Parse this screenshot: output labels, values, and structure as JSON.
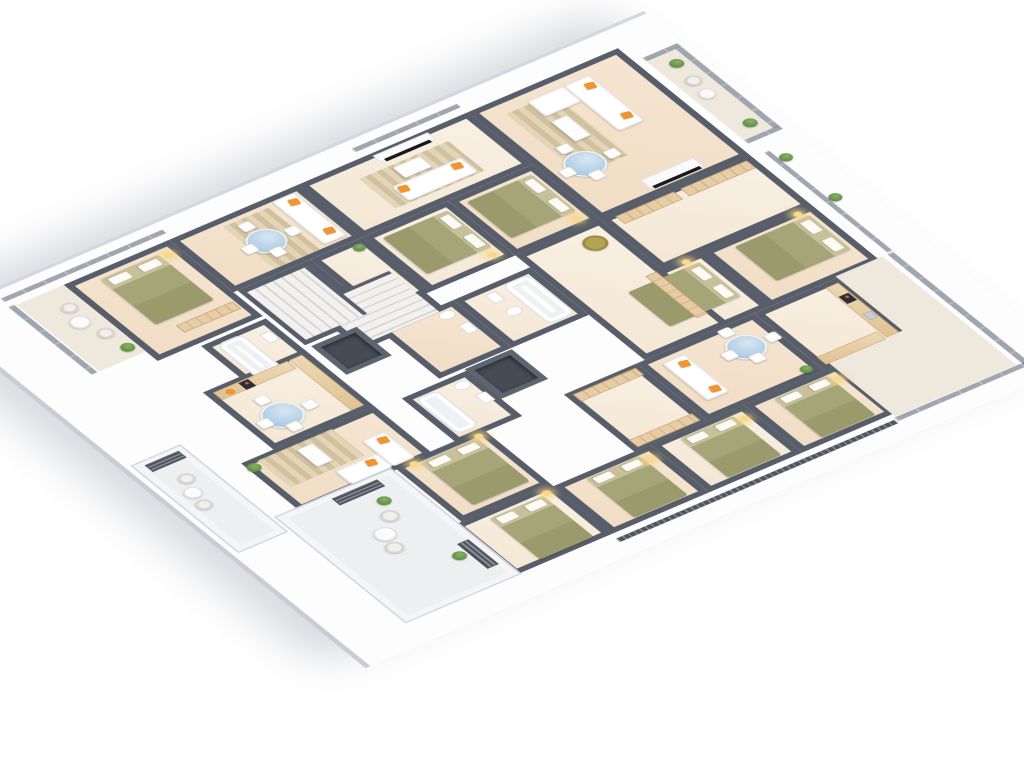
{
  "meta": {
    "description": "Isometric 3D rendering of an apartment building floor plan with dark grey walls, beige floors, furnished living rooms, bedrooms, kitchens, bathrooms, two staircases, elevator shafts and balconies with glass railings",
    "background": "#ffffff"
  },
  "palette": {
    "wall": "#575e69",
    "floor_warm": "#f4e3cf",
    "floor_light": "#f8efe2",
    "balcony_tile": "#efe8dc",
    "terrace_tile": "#edeff1",
    "slab": "#fdfdfe",
    "bed_olive": "#a2a173",
    "sofa_white": "#ffffff",
    "accent_orange": "#f0952f",
    "glass_table_blue": "#b9d4e7",
    "plant_green": "#6c9b50",
    "wood": "#e6cba2",
    "rail_glass": "#545e6e",
    "shaft_dark": "#454c56",
    "lamp_glow": "#f7d98b"
  },
  "scene": {
    "left": 620,
    "top": 40,
    "rotateX": 54,
    "rotateZ": 54,
    "width": 680,
    "height": 760
  },
  "slab": {
    "x": -26,
    "y": -48,
    "w": 736,
    "h": 876
  },
  "rooms": [
    {
      "name": "top-living",
      "k": "fa",
      "x": 10,
      "y": 10,
      "w": 225,
      "h": 185
    },
    {
      "name": "top-hall",
      "k": "fb",
      "x": 235,
      "y": 10,
      "w": 105,
      "h": 185
    },
    {
      "name": "top-bedroom-a",
      "k": "fa",
      "x": 340,
      "y": 10,
      "w": 115,
      "h": 135
    },
    {
      "name": "top-bedroom-b",
      "k": "fb",
      "x": 340,
      "y": 145,
      "w": 115,
      "h": 110
    },
    {
      "name": "right-kitchen",
      "k": "fb",
      "x": 455,
      "y": 60,
      "w": 120,
      "h": 105
    },
    {
      "name": "right-living",
      "k": "fa",
      "x": 455,
      "y": 165,
      "w": 120,
      "h": 145
    },
    {
      "name": "right-hall",
      "k": "fb",
      "x": 455,
      "y": 310,
      "w": 120,
      "h": 90
    },
    {
      "name": "right-bedroom-1",
      "k": "fa",
      "x": 575,
      "y": 150,
      "w": 100,
      "h": 115
    },
    {
      "name": "right-bedroom-2",
      "k": "fb",
      "x": 575,
      "y": 265,
      "w": 100,
      "h": 115
    },
    {
      "name": "right-bedroom-3",
      "k": "fa",
      "x": 575,
      "y": 380,
      "w": 100,
      "h": 120
    },
    {
      "name": "upper-bedroom-a",
      "k": "fa",
      "x": 120,
      "y": 195,
      "w": 115,
      "h": 105
    },
    {
      "name": "upper-bedroom-b",
      "k": "fb",
      "x": 120,
      "y": 300,
      "w": 115,
      "h": 105
    },
    {
      "name": "upper-living-tv",
      "k": "fb",
      "x": 10,
      "y": 195,
      "w": 110,
      "h": 210
    },
    {
      "name": "upper-living-2",
      "k": "fa",
      "x": 10,
      "y": 405,
      "w": 110,
      "h": 160
    },
    {
      "name": "hall-a",
      "k": "fb",
      "x": 235,
      "y": 195,
      "w": 220,
      "h": 105
    },
    {
      "name": "stairwell-a",
      "k": "fb",
      "x": 175,
      "y": 410,
      "w": 100,
      "h": 110
    },
    {
      "name": "bath-a",
      "k": "fb",
      "x": 260,
      "y": 300,
      "w": 100,
      "h": 95
    },
    {
      "name": "bath-b",
      "k": "fa",
      "x": 260,
      "y": 395,
      "w": 100,
      "h": 90
    },
    {
      "name": "bath-c",
      "k": "fb",
      "x": 365,
      "y": 455,
      "w": 95,
      "h": 80
    },
    {
      "name": "hall-b",
      "k": "fb",
      "x": 120,
      "y": 405,
      "w": 115,
      "h": 65
    },
    {
      "name": "stairwell-b",
      "k": "fb",
      "x": 120,
      "y": 470,
      "w": 115,
      "h": 90
    },
    {
      "name": "bath-left",
      "k": "fb",
      "x": 175,
      "y": 565,
      "w": 85,
      "h": 80
    },
    {
      "name": "left-bedroom",
      "k": "fa",
      "x": 10,
      "y": 565,
      "w": 160,
      "h": 130
    },
    {
      "name": "left-balcony",
      "k": "balc",
      "x": 10,
      "y": 695,
      "w": 140,
      "h": 58
    },
    {
      "name": "kitchen-bottom",
      "k": "fb",
      "x": 240,
      "y": 565,
      "w": 120,
      "h": 125
    },
    {
      "name": "living-bottom",
      "k": "fa",
      "x": 360,
      "y": 565,
      "w": 100,
      "h": 165
    },
    {
      "name": "bottom-bedroom-1",
      "k": "fa",
      "x": 455,
      "y": 500,
      "w": 115,
      "h": 110
    },
    {
      "name": "bottom-bedroom-corner",
      "k": "fb",
      "x": 570,
      "y": 500,
      "w": 105,
      "h": 120
    },
    {
      "name": "top-balcony",
      "k": "balc",
      "x": 44,
      "y": -36,
      "w": 168,
      "h": 36
    },
    {
      "name": "right-terrace-strip",
      "k": "balc",
      "x": 452,
      "y": 4,
      "w": 228,
      "h": 58
    },
    {
      "name": "right-terrace-corner",
      "k": "balc",
      "x": 566,
      "y": 4,
      "w": 114,
      "h": 150
    },
    {
      "name": "bottom-terrace",
      "k": "terr",
      "x": 455,
      "y": 615,
      "w": 220,
      "h": 140
    },
    {
      "name": "outer-terrace",
      "k": "terr",
      "x": 300,
      "y": 762,
      "w": 180,
      "h": 58
    }
  ],
  "railings": [
    {
      "kind": "glass",
      "x": 44,
      "y": -43,
      "w": 168,
      "h": 7
    },
    {
      "kind": "glassv",
      "x": 38,
      "y": -43,
      "w": 7,
      "h": 43
    },
    {
      "kind": "glassv",
      "x": 211,
      "y": -43,
      "w": 7,
      "h": 43
    },
    {
      "kind": "glass",
      "x": 240,
      "y": -10,
      "w": 210,
      "h": 6
    },
    {
      "kind": "glass",
      "x": 452,
      "y": -9,
      "w": 236,
      "h": 7
    },
    {
      "kind": "glassv",
      "x": 681,
      "y": -4,
      "w": 7,
      "h": 160
    },
    {
      "kind": "slat",
      "x": 684,
      "y": 158,
      "w": 7,
      "h": 344
    },
    {
      "kind": "glassv",
      "x": -8,
      "y": 196,
      "w": 7,
      "h": 130
    },
    {
      "kind": "glassv",
      "x": -8,
      "y": 560,
      "w": 7,
      "h": 200
    },
    {
      "kind": "glass",
      "x": 8,
      "y": 755,
      "w": 142,
      "h": 7
    }
  ],
  "furniture": [
    {
      "t": "rug",
      "x": 35,
      "y": 108,
      "w": 128,
      "h": 58
    },
    {
      "t": "sofa",
      "x": 30,
      "y": 60,
      "w": 95,
      "h": 32
    },
    {
      "t": "sofa",
      "x": 30,
      "y": 92,
      "w": 32,
      "h": 45
    },
    {
      "t": "pillow",
      "x": 40,
      "y": 64,
      "w": 11,
      "h": 11
    },
    {
      "t": "pillow",
      "x": 102,
      "y": 64,
      "w": 11,
      "h": 11
    },
    {
      "t": "coffee",
      "x": 72,
      "y": 118,
      "w": 42,
      "h": 20
    },
    {
      "t": "tvunit",
      "x": 205,
      "y": 58,
      "w": 18,
      "h": 66
    },
    {
      "t": "tv",
      "x": 220,
      "y": 62,
      "w": 5,
      "h": 58
    },
    {
      "t": "tglass",
      "x": 128,
      "y": 130,
      "w": 44,
      "h": 44
    },
    {
      "t": "plant",
      "x": 58,
      "y": -30,
      "w": 15,
      "h": 15
    },
    {
      "t": "wicker",
      "x": 90,
      "y": -28,
      "w": 18,
      "h": 18
    },
    {
      "t": "twhite",
      "x": 116,
      "y": -26,
      "w": 18,
      "h": 18
    },
    {
      "t": "plant",
      "x": 183,
      "y": -30,
      "w": 15,
      "h": 15
    },
    {
      "t": "plant",
      "x": 252,
      "y": -24,
      "w": 14,
      "h": 14
    },
    {
      "t": "plant",
      "x": 336,
      "y": -24,
      "w": 14,
      "h": 14
    },
    {
      "t": "wardv",
      "x": 240,
      "y": 18,
      "w": 16,
      "h": 82
    },
    {
      "t": "wardv",
      "x": 240,
      "y": 108,
      "w": 16,
      "h": 72
    },
    {
      "t": "bed",
      "dir": "n",
      "x": 352,
      "y": 22,
      "w": 72,
      "h": 92
    },
    {
      "t": "lamp",
      "x": 340,
      "y": 26,
      "w": 9,
      "h": 9
    },
    {
      "t": "bed",
      "dir": "n",
      "x": 352,
      "y": 158,
      "w": 72,
      "h": 88
    },
    {
      "t": "lamp",
      "x": 340,
      "y": 164,
      "w": 9,
      "h": 9
    },
    {
      "t": "counter",
      "x": 462,
      "y": 66,
      "w": 104,
      "h": 16
    },
    {
      "t": "counter",
      "x": 552,
      "y": 84,
      "w": 16,
      "h": 74
    },
    {
      "t": "cooktop",
      "x": 482,
      "y": 68,
      "w": 15,
      "h": 12
    },
    {
      "t": "sink",
      "x": 520,
      "y": 68,
      "w": 13,
      "h": 10
    },
    {
      "t": "tglass",
      "x": 476,
      "y": 184,
      "w": 42,
      "h": 42
    },
    {
      "t": "sofa",
      "x": 470,
      "y": 262,
      "w": 78,
      "h": 28
    },
    {
      "t": "pillow",
      "x": 478,
      "y": 266,
      "w": 11,
      "h": 11
    },
    {
      "t": "pillow",
      "x": 530,
      "y": 266,
      "w": 11,
      "h": 11
    },
    {
      "t": "plant",
      "x": 556,
      "y": 172,
      "w": 13,
      "h": 13
    },
    {
      "t": "wardv",
      "x": 460,
      "y": 315,
      "w": 15,
      "h": 78
    },
    {
      "t": "wardv",
      "x": 556,
      "y": 315,
      "w": 15,
      "h": 78
    },
    {
      "t": "bed",
      "dir": "w",
      "x": 584,
      "y": 168,
      "w": 82,
      "h": 66
    },
    {
      "t": "lamp",
      "x": 590,
      "y": 158,
      "w": 9,
      "h": 9
    },
    {
      "t": "bed",
      "dir": "w",
      "x": 584,
      "y": 284,
      "w": 82,
      "h": 66
    },
    {
      "t": "lamp",
      "x": 590,
      "y": 274,
      "w": 9,
      "h": 9
    },
    {
      "t": "bed",
      "dir": "w",
      "x": 584,
      "y": 400,
      "w": 82,
      "h": 66
    },
    {
      "t": "lamp",
      "x": 590,
      "y": 390,
      "w": 9,
      "h": 9
    },
    {
      "t": "bed",
      "dir": "n",
      "x": 133,
      "y": 206,
      "w": 76,
      "h": 80
    },
    {
      "t": "lamp",
      "x": 216,
      "y": 210,
      "w": 9,
      "h": 9
    },
    {
      "t": "bed",
      "dir": "n",
      "x": 133,
      "y": 310,
      "w": 76,
      "h": 80
    },
    {
      "t": "lamp",
      "x": 216,
      "y": 314,
      "w": 9,
      "h": 9
    },
    {
      "t": "tvunit",
      "x": 14,
      "y": 248,
      "w": 14,
      "h": 68
    },
    {
      "t": "tv",
      "x": 25,
      "y": 254,
      "w": 5,
      "h": 56
    },
    {
      "t": "rug",
      "x": 38,
      "y": 240,
      "w": 62,
      "h": 110
    },
    {
      "t": "sofa",
      "x": 68,
      "y": 246,
      "w": 30,
      "h": 86
    },
    {
      "t": "pillow",
      "x": 72,
      "y": 252,
      "w": 11,
      "h": 11
    },
    {
      "t": "pillow",
      "x": 72,
      "y": 318,
      "w": 11,
      "h": 11
    },
    {
      "t": "coffee",
      "x": 42,
      "y": 278,
      "w": 22,
      "h": 34
    },
    {
      "t": "sofa",
      "x": 18,
      "y": 416,
      "w": 90,
      "h": 28
    },
    {
      "t": "pillow",
      "x": 26,
      "y": 420,
      "w": 11,
      "h": 11
    },
    {
      "t": "pillow",
      "x": 86,
      "y": 420,
      "w": 11,
      "h": 11
    },
    {
      "t": "rug",
      "x": 24,
      "y": 452,
      "w": 88,
      "h": 56
    },
    {
      "t": "tglass",
      "x": 48,
      "y": 466,
      "w": 42,
      "h": 42
    },
    {
      "t": "tub",
      "x": 182,
      "y": 600,
      "w": 72,
      "h": 32
    },
    {
      "t": "basin",
      "x": 194,
      "y": 574,
      "w": 18,
      "h": 13
    },
    {
      "t": "bed",
      "dir": "w",
      "x": 24,
      "y": 588,
      "w": 95,
      "h": 72
    },
    {
      "t": "lamp",
      "x": 26,
      "y": 576,
      "w": 9,
      "h": 9
    },
    {
      "t": "wardv",
      "x": 132,
      "y": 575,
      "w": 15,
      "h": 70
    },
    {
      "t": "twhite",
      "x": 60,
      "y": 708,
      "w": 22,
      "h": 22
    },
    {
      "t": "wicker",
      "x": 36,
      "y": 704,
      "w": 18,
      "h": 18
    },
    {
      "t": "wicker",
      "x": 92,
      "y": 700,
      "w": 18,
      "h": 18
    },
    {
      "t": "plant",
      "x": 126,
      "y": 698,
      "w": 15,
      "h": 15
    },
    {
      "t": "armchair",
      "x": 252,
      "y": 210,
      "w": 26,
      "h": 26
    },
    {
      "t": "wardh",
      "x": 340,
      "y": 202,
      "w": 88,
      "h": 14
    },
    {
      "t": "stairsh",
      "x": 182,
      "y": 418,
      "w": 86,
      "h": 94
    },
    {
      "t": "tub",
      "x": 268,
      "y": 308,
      "w": 82,
      "h": 34
    },
    {
      "t": "basin",
      "x": 272,
      "y": 352,
      "w": 18,
      "h": 13
    },
    {
      "t": "toilet",
      "x": 304,
      "y": 348,
      "w": 14,
      "h": 18
    },
    {
      "t": "toilet",
      "x": 270,
      "y": 406,
      "w": 14,
      "h": 18
    },
    {
      "t": "basin",
      "x": 298,
      "y": 404,
      "w": 18,
      "h": 13
    },
    {
      "t": "shaft",
      "x": 362,
      "y": 397,
      "w": 62,
      "h": 58
    },
    {
      "t": "toilet",
      "x": 376,
      "y": 464,
      "w": 14,
      "h": 18
    },
    {
      "t": "basin",
      "x": 404,
      "y": 460,
      "w": 18,
      "h": 13
    },
    {
      "t": "tub",
      "x": 374,
      "y": 498,
      "w": 74,
      "h": 28
    },
    {
      "t": "plant",
      "x": 126,
      "y": 412,
      "w": 13,
      "h": 13
    },
    {
      "t": "stairsv",
      "x": 128,
      "y": 478,
      "w": 100,
      "h": 76
    },
    {
      "t": "shaft",
      "x": 240,
      "y": 500,
      "w": 60,
      "h": 56
    },
    {
      "t": "counter",
      "x": 246,
      "y": 572,
      "w": 106,
      "h": 16
    },
    {
      "t": "counter",
      "x": 246,
      "y": 590,
      "w": 16,
      "h": 92
    },
    {
      "t": "cooktop",
      "x": 248,
      "y": 640,
      "w": 14,
      "h": 12
    },
    {
      "t": "bowl",
      "x": 250,
      "y": 662,
      "w": 10,
      "h": 10
    },
    {
      "t": "tglass",
      "x": 296,
      "y": 626,
      "w": 44,
      "h": 44
    },
    {
      "t": "sofa",
      "x": 400,
      "y": 582,
      "w": 54,
      "h": 28
    },
    {
      "t": "sofa",
      "x": 426,
      "y": 610,
      "w": 28,
      "h": 52
    },
    {
      "t": "pillow",
      "x": 406,
      "y": 586,
      "w": 11,
      "h": 11
    },
    {
      "t": "pillow",
      "x": 430,
      "y": 618,
      "w": 11,
      "h": 11
    },
    {
      "t": "rug",
      "x": 366,
      "y": 622,
      "w": 56,
      "h": 92
    },
    {
      "t": "coffee",
      "x": 374,
      "y": 652,
      "w": 36,
      "h": 20
    },
    {
      "t": "plant",
      "x": 366,
      "y": 716,
      "w": 15,
      "h": 15
    },
    {
      "t": "bed",
      "dir": "w",
      "x": 464,
      "y": 514,
      "w": 90,
      "h": 70
    },
    {
      "t": "lamp",
      "x": 458,
      "y": 506,
      "w": 9,
      "h": 9
    },
    {
      "t": "lamp",
      "x": 458,
      "y": 586,
      "w": 9,
      "h": 9
    },
    {
      "t": "bed",
      "dir": "w",
      "x": 582,
      "y": 518,
      "w": 86,
      "h": 66
    },
    {
      "t": "lamp",
      "x": 576,
      "y": 508,
      "w": 9,
      "h": 9
    },
    {
      "t": "wicker",
      "x": 510,
      "y": 652,
      "w": 20,
      "h": 20
    },
    {
      "t": "wicker",
      "x": 556,
      "y": 680,
      "w": 20,
      "h": 20
    },
    {
      "t": "twhite",
      "x": 530,
      "y": 672,
      "w": 24,
      "h": 24
    },
    {
      "t": "plant",
      "x": 488,
      "y": 644,
      "w": 15,
      "h": 15
    },
    {
      "t": "plant",
      "x": 608,
      "y": 638,
      "w": 15,
      "h": 15
    },
    {
      "t": "ventv",
      "x": 462,
      "y": 636,
      "w": 14,
      "h": 56
    },
    {
      "t": "venth",
      "x": 598,
      "y": 622,
      "w": 52,
      "h": 14
    },
    {
      "t": "wicker",
      "x": 340,
      "y": 780,
      "w": 18,
      "h": 18
    },
    {
      "t": "wicker",
      "x": 386,
      "y": 792,
      "w": 18,
      "h": 18
    },
    {
      "t": "twhite",
      "x": 362,
      "y": 788,
      "w": 20,
      "h": 20
    },
    {
      "t": "ventv",
      "x": 306,
      "y": 768,
      "w": 14,
      "h": 42
    }
  ]
}
